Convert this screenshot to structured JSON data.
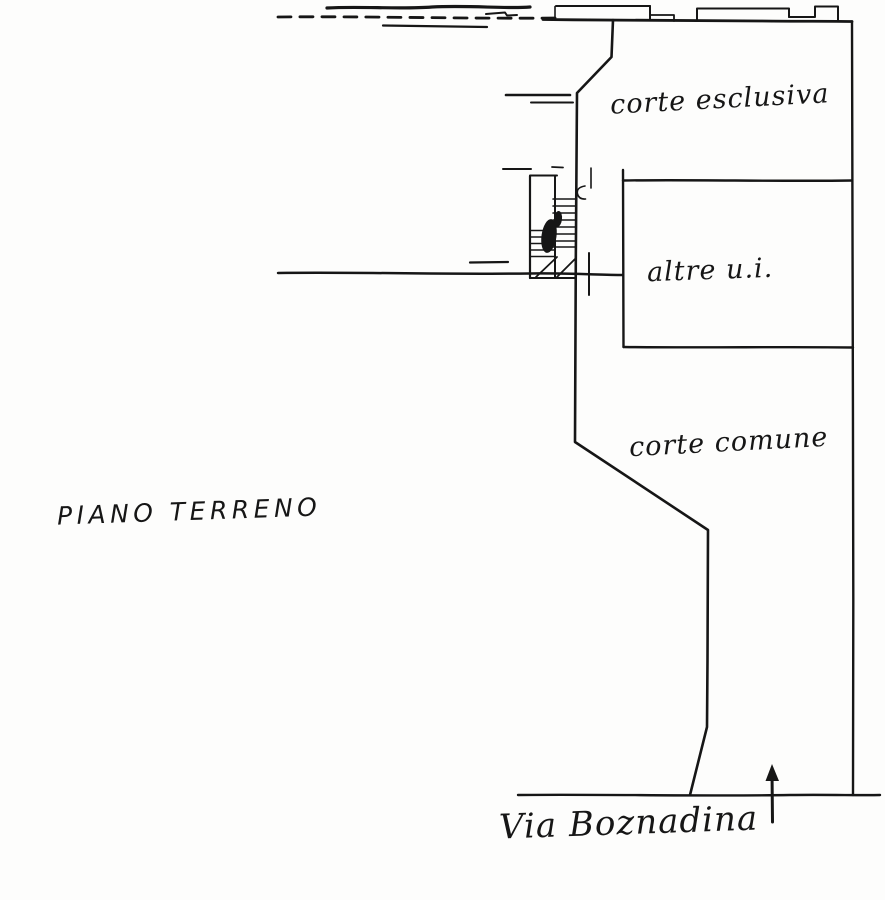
{
  "plan": {
    "floor_label": "PIANO TERRENO",
    "regions": {
      "exclusive_court": "corte esclusiva",
      "other_units": "altre u.i.",
      "common_court": "corte comune"
    },
    "street": "Via Boznadina"
  },
  "icons": {
    "north_arrow": "up-arrow-icon",
    "stairs": "stairs-symbol"
  },
  "colors": {
    "ink": "#161616",
    "paper": "#fdfdfc"
  }
}
